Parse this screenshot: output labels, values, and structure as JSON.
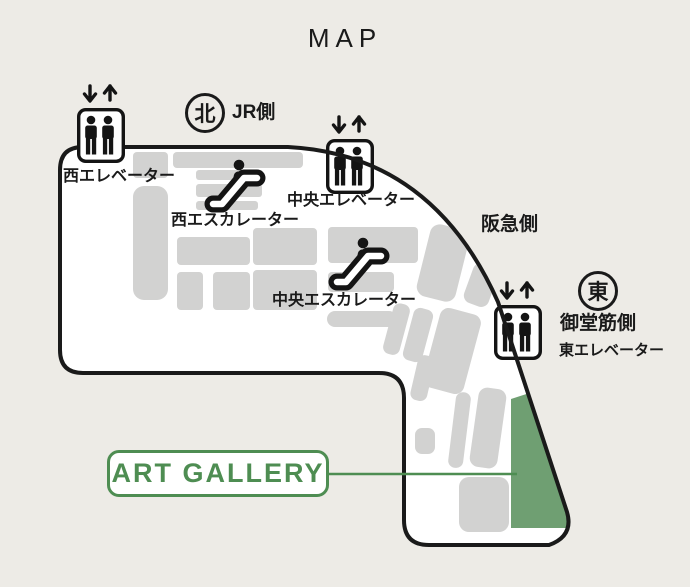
{
  "page": {
    "title": "MAP"
  },
  "map": {
    "compass_north": {
      "symbol": "北",
      "label": "JR側"
    },
    "compass_east": {
      "symbol": "東",
      "label": "御堂筋側"
    },
    "side_label_hankyu": "阪急側",
    "facilities": {
      "west_elevator": "西エレベーター",
      "west_escalator": "西エスカレーター",
      "central_elevator": "中央エレベーター",
      "central_escalator": "中央エスカレーター",
      "east_elevator": "東エレベーター"
    },
    "gallery_label": "ART GALLERY",
    "colors": {
      "accent_green": "#4e8d52",
      "area_green": "#6f9f72",
      "block_gray": "#d2d2d1",
      "background": "#edebe6",
      "outline": "#1a1a1a"
    }
  }
}
